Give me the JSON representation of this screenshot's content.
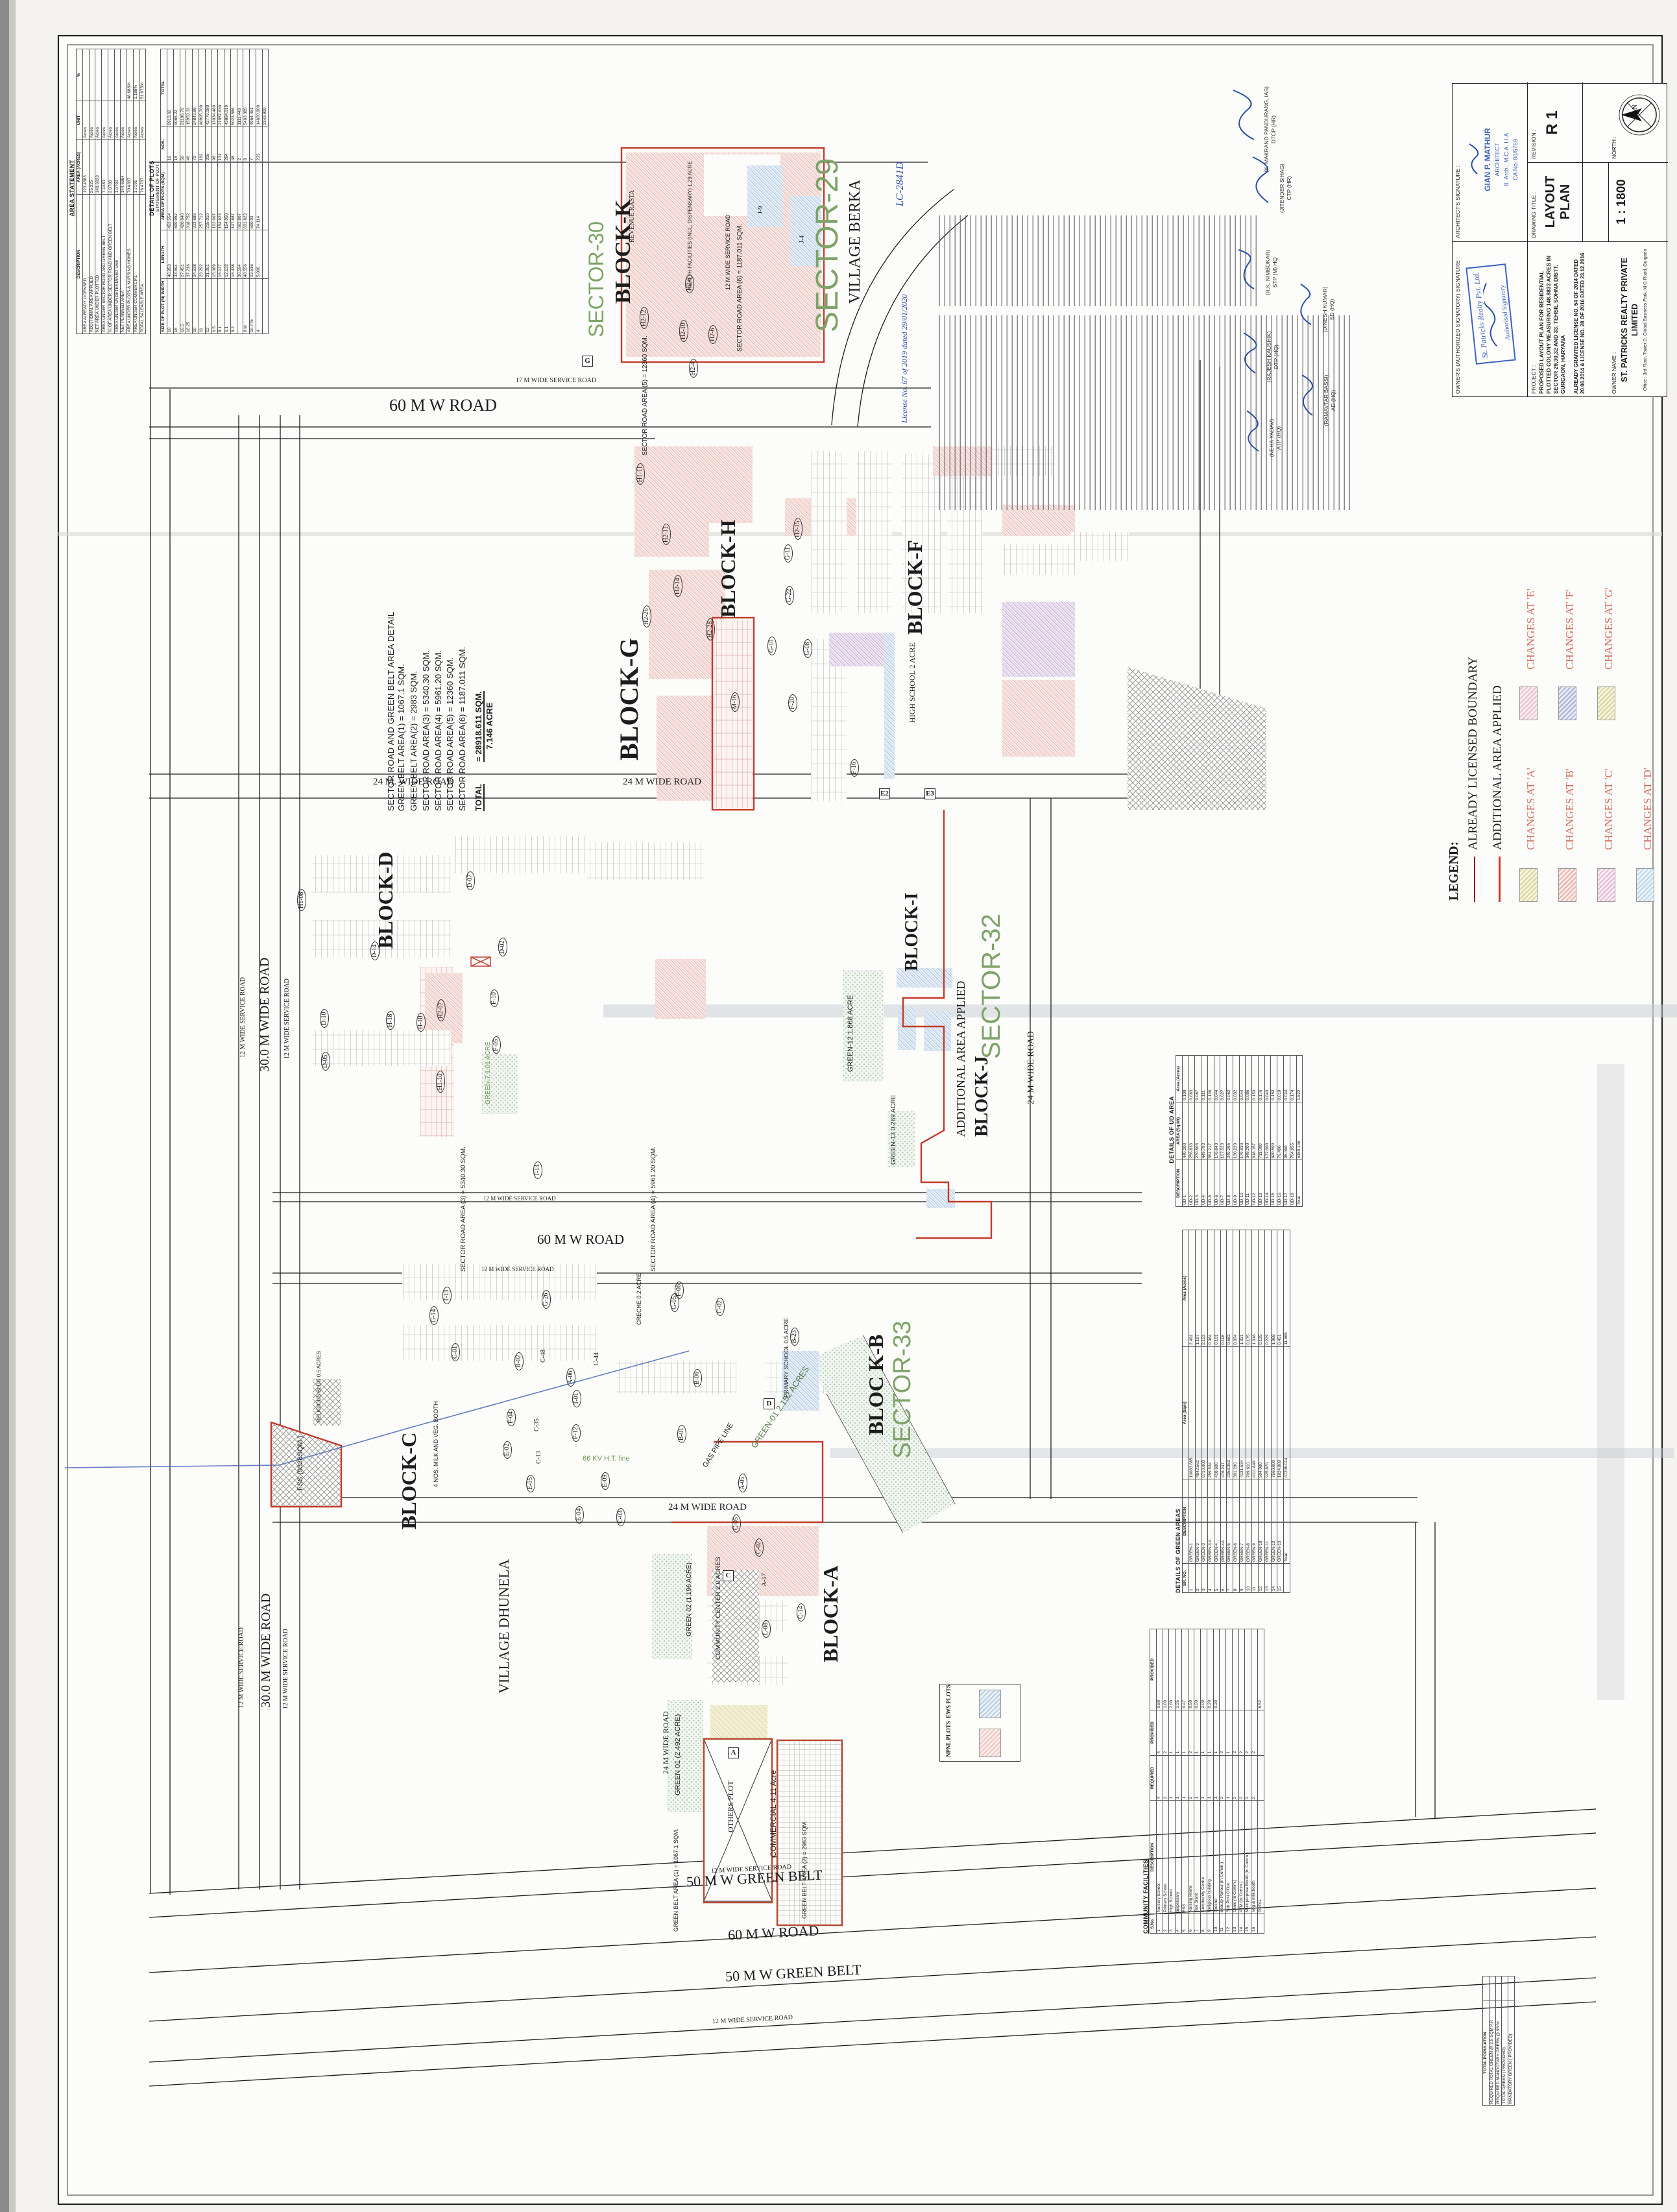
{
  "title_block": {
    "owner_sig_label": "OWNER'S (AUTHORIZED SIGNATORY) SIGNATURE :",
    "owner_stamp_line1": "St. Patricks Realty Pvt. Ltd.",
    "owner_stamp_line2": "Authorised Signatory",
    "architect_sig_label": "ARCHITECT'S SIGNATURE :",
    "architect_stamp_line1": "GIAN P. MATHUR",
    "architect_stamp_line2": "ARCHITECT",
    "architect_stamp_line3": "B. Arch., M.C.A. I.I.A",
    "architect_stamp_line4": "CA No. 80/5769",
    "project_label": "PROJECT :",
    "project_text": "PROPOSED LAYOUT PLAN FOR RESIDENTIAL PLOTTED COLONY MEASURING 148.8833 ACRES IN SECTOR 29,30,32 AND 33, TEHSIL SOHNA DISTT. GURGAON, HARYANA",
    "project_text2": "ALREADY GRANTED LICENSE NO. 54 OF 2014 DATED 20.06.2014 & LICENSE NO. 28 OF 2016 DATED 23.12.2016",
    "drawing_title_label": "DRAWING TITLE :",
    "drawing_title": "LAYOUT PLAN",
    "scale": "1 : 1800",
    "revision_label": "REVISION :",
    "revision": "R 1",
    "north_label": "NORTH :",
    "owner_name_label": "OWNER NAME :",
    "owner_name": "ST. PATRICKS REALTY PRIVATE LIMITED",
    "owner_address": "Office : 3rd Floor, Tower D, Global Business Park, M G Road, Gurgaon"
  },
  "legend": {
    "title": "LEGEND:",
    "boundary1": "ALREADY LICENSED BOUNDARY",
    "boundary2": "ADDITIONAL AREA APPLIED",
    "changes": [
      "CHANGES AT 'A'",
      "CHANGES AT 'B'",
      "CHANGES AT 'C'",
      "CHANGES AT 'D'",
      "CHANGES AT 'E'",
      "CHANGES AT 'F'",
      "CHANGES AT 'G'"
    ]
  },
  "notes_signatures": [
    {
      "n": "(NEHA YADAV)",
      "t": "ATP (HQ)"
    },
    {
      "n": "(RAJESH KAUSHIK)",
      "t": "DTP (HQ)"
    },
    {
      "n": "(R.K. NIMBOKAR)",
      "t": "STP (M) HQ"
    },
    {
      "n": "(RAMAVTAR BASSI)",
      "t": "AD (HQ)"
    },
    {
      "n": "(DINESH KUMAR)",
      "t": "SD (HQ)"
    },
    {
      "n": "(JITENDER SIHAG)",
      "t": "CTP (HR)"
    },
    {
      "n": "(K. MAKRAND PANDURANG, IAS)",
      "t": "DTCP (HR)"
    }
  ],
  "handwritten": {
    "lc_no": "LC-2841D",
    "license": "License No. 67 of 2019 dated 29/01/2020"
  },
  "area_statement": {
    "title": "AREA STATEMENT",
    "rows": [
      [
        "DESCRIPTION",
        "AREA (ACRES)",
        "UNIT",
        "%"
      ],
      [
        "AREA ALREADY LICENSED",
        "123.4583",
        "Acres",
        ""
      ],
      [
        "ADDITIONAL AREA APPLIED",
        "25.225",
        "Acres",
        ""
      ],
      [
        "NET AREA UNDER PLOTTED",
        "148.6833",
        "Acres",
        ""
      ],
      [
        "AREA UNDER SECTOR ROAD AND GREEN BELT",
        "7.1480",
        "Acres",
        ""
      ],
      [
        "% OF AREA UNDER SECTOR ROAD AND GREEN BELT",
        "3.0780",
        "Acres",
        ""
      ],
      [
        "AREA UNDER UNDETERMINED USE",
        "1.0790",
        "Acres",
        ""
      ],
      [
        "NET PLANNED AREA",
        "144.6984",
        "Acres",
        ""
      ],
      [
        "AREA UNDER PLOTS & NURSING HOMES",
        "70.4387",
        "Acres",
        "48.686%"
      ],
      [
        "AREA UNDER COMMERCIAL",
        "1.7191",
        "Acres",
        "1.188%"
      ],
      [
        "TOTAL SALEABLE AREA",
        "76.4787",
        "Acres",
        "51.975%"
      ]
    ]
  },
  "detail_of_plots": {
    "title": "DETAIL OF PLOTS",
    "subtitle": "STATEMENT OF PLOT",
    "rows": [
      [
        "SIZE OF PLOT (M)  WIDTH",
        "LENGTH",
        "AREA OF PLOTS (SQM)",
        "NOS.",
        "TOTAL"
      ],
      [
        "10",
        "46.853",
        "453.554",
        "16",
        "8913.62"
      ],
      [
        "16",
        "33.594",
        "600.952",
        "15",
        "9065.22"
      ],
      [
        "16.5",
        "27.451",
        "420.040",
        "56",
        "21106.70"
      ],
      [
        "16.25",
        "37.216",
        "318.752",
        "46",
        "15953.33"
      ],
      [
        "10",
        "24.538",
        "313.686",
        "79",
        "24843.89"
      ],
      [
        "11",
        "23.292",
        "257.712",
        "182",
        "46905.700"
      ],
      [
        "12",
        "21.001",
        "215.010",
        "205",
        "42779.080"
      ],
      [
        "6.5",
        "15.089",
        "122.007",
        "98",
        "13034.480"
      ],
      [
        "8.1",
        "15.127",
        "154.923",
        "131",
        "21057.630"
      ],
      [
        "6.1",
        "12.132",
        "154.050",
        "284",
        "43884.019"
      ],
      [
        "8.2",
        "18.438",
        "107.887",
        "48",
        "5023.586"
      ],
      [
        "",
        "36.594",
        "662.807",
        "2",
        "1111.448"
      ],
      [
        "8 M",
        "48.556",
        "631.823",
        "8",
        "5463.385"
      ],
      [
        "10.775",
        "12.516",
        "500.03",
        "7",
        "4964.451"
      ],
      [
        "4",
        "5.006",
        "74.114",
        "233",
        "14620.900"
      ],
      [
        "",
        "",
        "",
        "",
        "2343.900"
      ]
    ]
  },
  "sector_road_detail": {
    "title": "SECTOR ROAD AND GREEN BELT AREA DETAIL",
    "lines": [
      "GREEN BELT AREA(1) =  1067.1 SQM.",
      "GREEN BELT AREA(2) =  2983 SQM.",
      "SECTOR ROAD AREA(3) = 5340.30 SQM.",
      "SECTOR ROAD AREA(4) = 5961.20 SQM.",
      "SECTOR ROAD AREA(5) = 12360 SQM.",
      "SECTOR ROAD AREA(6) = 1187.011 SQM."
    ],
    "total_label": "TOTAL",
    "total_sqm": "=  28918.611 SQM.",
    "total_acre": "7.146 ACRE"
  },
  "ud_area": {
    "title": "DETAILS OF UD AREA",
    "rows": [
      [
        "DESCRIPTION",
        "AREA (Sq.Mt)",
        "Area (Acres)"
      ],
      [
        "UD-1",
        "440.200",
        "0.109"
      ],
      [
        "UD-2",
        "256.833",
        "0.063"
      ],
      [
        "UD-3",
        "270.503",
        "0.067"
      ],
      [
        "UD-4",
        "449.793",
        "0.111"
      ],
      [
        "UD-5",
        "551.217",
        "0.136"
      ],
      [
        "UD-6",
        "176.840",
        "0.044"
      ],
      [
        "UD-7",
        "107.523",
        "0.027"
      ],
      [
        "UD-8",
        "249.295",
        "0.062"
      ],
      [
        "UD-9",
        "130.220",
        "0.032"
      ],
      [
        "UD-10",
        "179.930",
        "0.044"
      ],
      [
        "UD-11",
        "348.200",
        "0.086"
      ],
      [
        "UD-12",
        "618.157",
        "0.153"
      ],
      [
        "UD-13",
        "711.000",
        "0.176"
      ],
      [
        "UD-14",
        "172.000",
        "0.043"
      ],
      [
        "UD-15",
        "620.500",
        "0.153"
      ],
      [
        "UD-16",
        "76.490",
        "0.019"
      ],
      [
        "UD-17",
        "95.490",
        "0.024"
      ],
      [
        "UD-18",
        "704.955",
        "0.174"
      ],
      [
        "Total",
        "6159.146",
        "1.522"
      ]
    ]
  },
  "green_areas": {
    "title": "DETAILS OF GREEN AREAS",
    "rows": [
      [
        "SR. NO.",
        "DESCRIPTION",
        "Area (Sqm)",
        "Area (Acres)"
      ],
      [
        "1",
        "GREEN-1",
        "10083.685",
        "2.492"
      ],
      [
        "2",
        "GREEN-2",
        "4842.562",
        "1.197"
      ],
      [
        "3",
        "GREEN-3",
        "8710.000",
        "2.152"
      ],
      [
        "4",
        "GREEN-3 A",
        "259.534",
        "0.064"
      ],
      [
        "5",
        "GREEN-4",
        "410.600",
        "0.101"
      ],
      [
        "6",
        "GREEN-4A",
        "476.247",
        "0.118"
      ],
      [
        "7",
        "GREEN-5",
        "2353.353",
        "0.582"
      ],
      [
        "8",
        "GREEN-6",
        "301.290",
        "0.074"
      ],
      [
        "9",
        "GREEN-7",
        "4131.534",
        "1.021"
      ],
      [
        "10",
        "GREEN-8",
        "709.610",
        "0.175"
      ],
      [
        "11",
        "GREEN-9",
        "4111.849",
        "1.016"
      ],
      [
        "12",
        "GREEN-10",
        "504.000",
        "0.125"
      ],
      [
        "13",
        "GREEN-11",
        "925.870",
        "0.229"
      ],
      [
        "14",
        "GREEN-12",
        "7560.000",
        "1.868"
      ],
      [
        "15",
        "GREEN-13",
        "1824.880",
        "0.451"
      ],
      [
        "",
        "Total",
        "47205.014",
        "11.665"
      ]
    ]
  },
  "community_facilities": {
    "title": "COMMUNITY FACILITIES",
    "rows": [
      [
        "S.No.",
        "DESCRIPTION",
        "REQUIRED",
        "PROVIDED",
        "PROVIDED"
      ],
      [
        "1",
        "Nursery School",
        "4",
        "4",
        "0.80"
      ],
      [
        "2",
        "Primary School",
        "2",
        "2",
        "1.00"
      ],
      [
        "3",
        "High School",
        "1",
        "1",
        "2.00"
      ],
      [
        "4",
        "dispensary",
        "1",
        "1",
        "1.25"
      ],
      [
        "5",
        "ESS",
        "1",
        "1",
        "0.47"
      ],
      [
        "6",
        "Nursing Home",
        "2",
        "2",
        "0.50"
      ],
      [
        "7",
        "Taxi Stand",
        "1",
        "1",
        "0.50"
      ],
      [
        "8",
        "Community Centre",
        "1",
        "1",
        "2.00"
      ],
      [
        "9",
        "Religious building",
        "1",
        "1",
        "0.20"
      ],
      [
        "10",
        "Creche",
        "1",
        "1",
        "0.20"
      ],
      [
        "11",
        "Beauty Parlour (In Comm.)",
        "2",
        "2",
        ""
      ],
      [
        "12",
        "Sub Post Office",
        "1",
        "1",
        ""
      ],
      [
        "13",
        "Clinic (In Comm.)",
        "2",
        "2",
        ""
      ],
      [
        "14",
        "ATM (In Comm.)",
        "2",
        "2",
        ""
      ],
      [
        "15",
        "Multi purpose Booth (In Comm.)",
        "2",
        "2",
        ""
      ],
      [
        "16",
        "Veg & milk booth",
        "2",
        "2",
        ""
      ],
      [
        "",
        "TOTAL",
        "",
        "",
        "8.52"
      ]
    ]
  },
  "green_summary": {
    "rows": [
      [
        "TOTAL POPULATION",
        ""
      ],
      [
        "REQUIRED TOTAL GREEN @ 2.5 SQM P.P.",
        ""
      ],
      [
        "REQUIRED MANDOTARY GREEN @ 95 %",
        ""
      ],
      [
        "TOTAL GREEN ( PROVIDED)",
        ""
      ],
      [
        "MANDATORY GREEN ( PROVIDED)",
        ""
      ]
    ]
  },
  "plots_key": {
    "npnl": "NPNL PLOTS",
    "ews": "EWS PLOTS"
  },
  "plan": {
    "labels": [
      "SECTOR-30",
      "BLOCK-K",
      "SECTOR-29",
      "VILLAGE BERKA",
      "BLOCK-G",
      "BLOCK-H",
      "BLOCK-F",
      "BLOCK-D",
      "BLOCK-I",
      "SECTOR-32",
      "BLOCK-J",
      "ADDITIONAL AREA APPLIED",
      "BLOC K-B",
      "SECTOR-33",
      "BLOCK-A",
      "BLOCK-C",
      "VILLAGE DHUNELA",
      "60 M W ROAD",
      "17 M WIDE SERVICE ROAD",
      "24 M. WIDE ROAD",
      "24 M WIDE ROAD",
      "60 M W ROAD",
      "12 M WIDE SERVICE ROAD",
      "12 M WIDE SERVICE ROAD",
      "24 M WIDE ROAD",
      "50 M W GREEN BELT",
      "60 M W ROAD",
      "50 M W GREEN BELT",
      "12 M WIDE SERVICE ROAD",
      "12 M WIDE SERVICE ROAD",
      "66 KV H.T. line",
      "GAS PIPE LINE",
      "REVENUE RASTA",
      "SECTOR ROAD AREA (3) = 5340.30 SQM.",
      "SECTOR ROAD AREA (4) = 5961.20 SQM.",
      "SECTOR ROAD AREA (5) = 12360 SQM.",
      "SECTOR ROAD AREA (6) = 1187.011 SQM.",
      "12 M WIDE SERVICE ROAD",
      "30.0 M WIDE ROAD",
      "30.0 M WIDE ROAD",
      "12 M WIDE SERVICE ROAD",
      "12 M WIDE SERVICE ROAD",
      "12 M WIDE SERVICE ROAD",
      "12 M WIDE SERVICE ROAD",
      "24 M WIDE ROAD",
      "24 M WIDE ROAD",
      "HIGH SCHOOL 2 ACRE",
      "GREEN-12 1.868 ACRE",
      "GREEN-13 0.269 ACRE",
      "GREEN-7 1.01 ACRE",
      "GREEN 01 (2.492 ACRE)",
      "OTHERS PLOT",
      "COMMERCIAL 4.11 Acre",
      "GREEN BELT AREA (1) = 1067.1 SQM.",
      "GREEN BELT AREA (2) = 2983 SQM.",
      "COMMUNITY CENTER 2.0 ACRES",
      "GREEN 02 (1.196 ACRE)",
      "PRIMARY SCHOOL 0.5 ACRE",
      "CRECHE 0.2 ACRE",
      "FSS (9338SQM.)",
      "4 NOS. MILK AND VEG. BOOTH",
      "RELIGIOUS BLDG 0.5 ACRES",
      "HEALTH FACILITIES (INCL. DISPENSARY) 1.29 ACRE",
      "GREEN-01 2.152 ACRES"
    ],
    "plots": [
      "J-9",
      "J-4",
      "H2-8",
      "H2-12",
      "H2-10",
      "H2-6",
      "H2-4",
      "H1-11",
      "H2-11",
      "H2-15",
      "H2-26",
      "H2-14",
      "H2-28",
      "G-11",
      "G-22",
      "G-10",
      "G-08",
      "F-20",
      "F-16",
      "M-16",
      "H1-08",
      "D-14",
      "D-07",
      "D-10",
      "D-05",
      "H-18",
      "H-10",
      "H2-07",
      "H1-10",
      "F-10",
      "F-05",
      "D-02",
      "T-14",
      "T-13",
      "G-14",
      "G-26",
      "C-48",
      "C-44",
      "C-01",
      "B-02",
      "A-06",
      "B-06",
      "B-01",
      "A-05",
      "E-09",
      "E-04",
      "C-03",
      "F-12",
      "F-06",
      "G-05",
      "C-02",
      "E-02",
      "E-05",
      "F-04",
      "C-13",
      "C-35",
      "T-01",
      "L-08",
      "C-14",
      "A-17",
      "C-05",
      "C-02",
      "B-23"
    ],
    "markers": [
      "G",
      "D",
      "A",
      "C",
      "E2",
      "E3"
    ]
  },
  "palette": {
    "boundary_red": "#c23b2a",
    "sector_green": "#7da368",
    "changes_text": "#d4705f",
    "blue_ink": "#2b4ea8",
    "swatch_a": "#dcd6a2",
    "swatch_b": "#e9b4ae",
    "swatch_c": "#e9b9d4",
    "swatch_d": "#bfd8ea",
    "swatch_e": "#ecc0cc",
    "swatch_f": "#a9b1d6",
    "swatch_g": "#d9d6a0",
    "npnl_pink": "#f0c9c4",
    "ews_blue": "#b8cfe4"
  }
}
